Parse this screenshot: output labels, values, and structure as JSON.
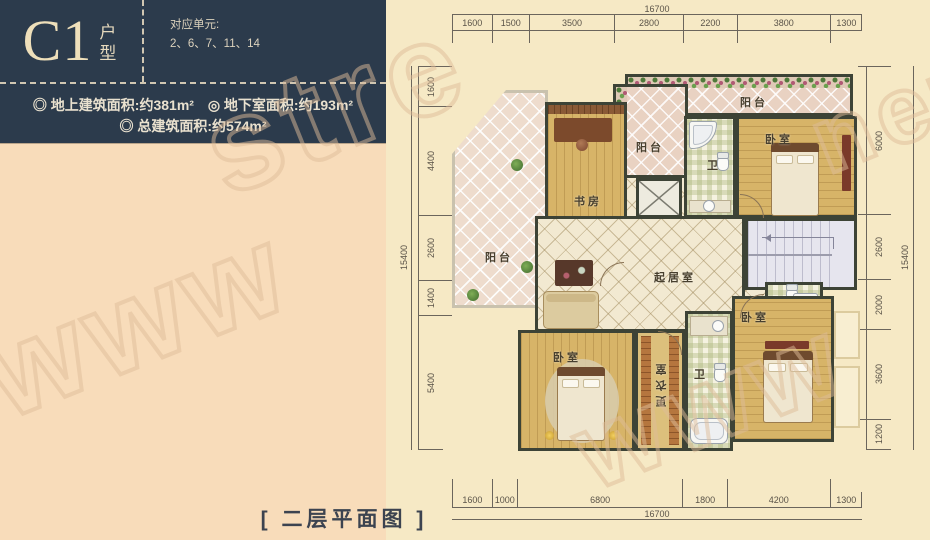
{
  "panel": {
    "unit_code": "C1",
    "unit_type": "户型",
    "units_label": "对应单元:",
    "units": "2、6、7、11、14",
    "areas": [
      "◎ 地上建筑面积:约381m²",
      "◎ 地下室面积:约193m²",
      "◎ 总建筑面积:约574m²"
    ]
  },
  "caption": "[ 二层平面图 ]",
  "plan": {
    "labels": {
      "balcony": "阳台",
      "study": "书房",
      "bath": "卫",
      "bedroom": "卧室",
      "living": "起居室",
      "dressing": "更衣室"
    }
  },
  "dimensions": {
    "top": {
      "total": "16700",
      "segments": [
        1600,
        1500,
        3500,
        2800,
        2200,
        3800,
        1300
      ]
    },
    "bottom": {
      "total": "16700",
      "segments": [
        1600,
        1000,
        6800,
        1800,
        4200,
        1300
      ]
    },
    "left": {
      "total": "15400",
      "segments": [
        1600,
        4400,
        2600,
        1400,
        5400
      ]
    },
    "right": {
      "total": "15400",
      "segments": [
        6000,
        2600,
        2000,
        3600,
        1200
      ]
    }
  },
  "watermarks": [
    "stre",
    "www",
    "www",
    "net"
  ],
  "colors": {
    "panel_navy": "#2c3b4c",
    "peach": "#f8dcba",
    "cream": "#f6e9c5",
    "wall": "#3d4336"
  }
}
